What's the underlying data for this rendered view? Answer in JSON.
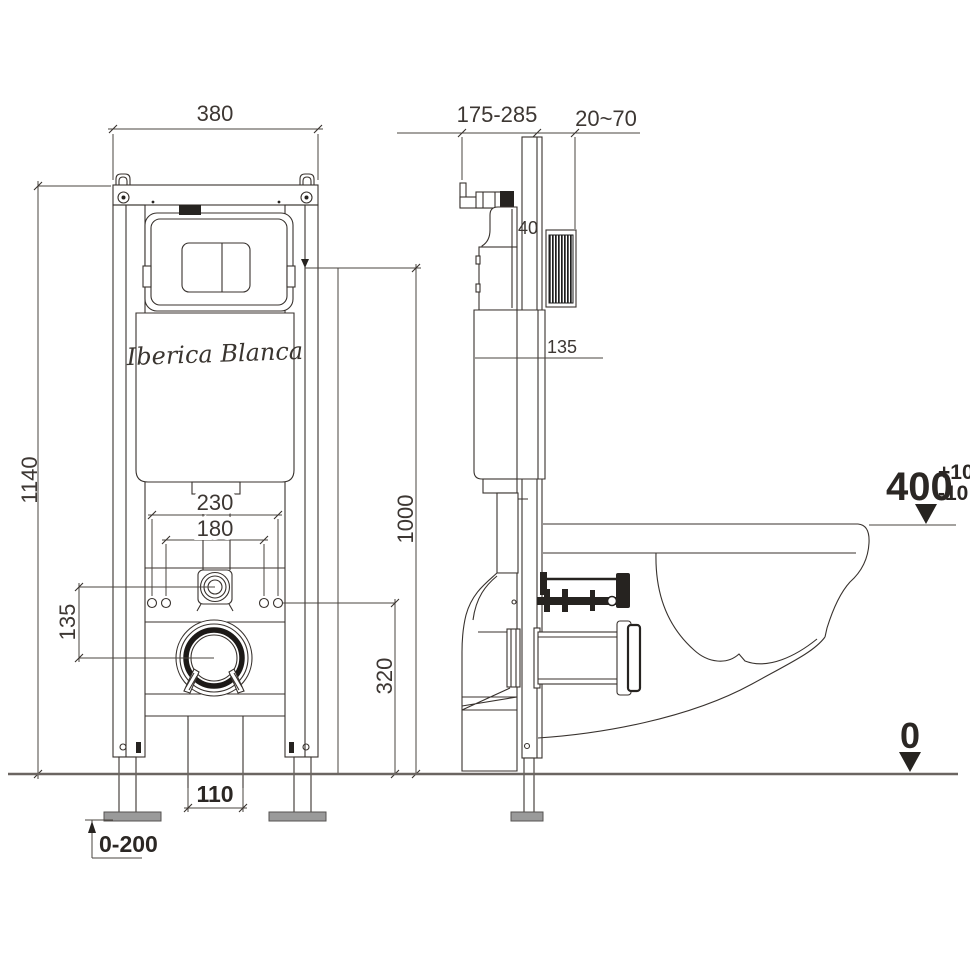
{
  "drawing": {
    "brand_label": "Iberica Blanca",
    "front": {
      "frame_width": "380",
      "frame_height": "1140",
      "fixing_outer_spacing": "230",
      "fixing_inner_spacing": "180",
      "inlet_drain_offset": "135",
      "drain_center_height": "320",
      "actuator_center_height": "1000",
      "drain_bracket_width": "110",
      "leg_adjust_range": "0-200"
    },
    "side": {
      "bracket_depth_range": "175-285",
      "wall_finish_thickness": "20~70",
      "plate_recess_depth": "40",
      "tank_reference": "135",
      "rim_height": "400",
      "rim_tolerance_plus": "+10",
      "rim_tolerance_minus": "-10",
      "floor_level": "0"
    },
    "colors": {
      "line": "#38322e",
      "dimension": "#4a443f",
      "floor_line": "#6b6561",
      "dark_fill": "#262320",
      "foot_plate": "#9a9a9a"
    }
  }
}
